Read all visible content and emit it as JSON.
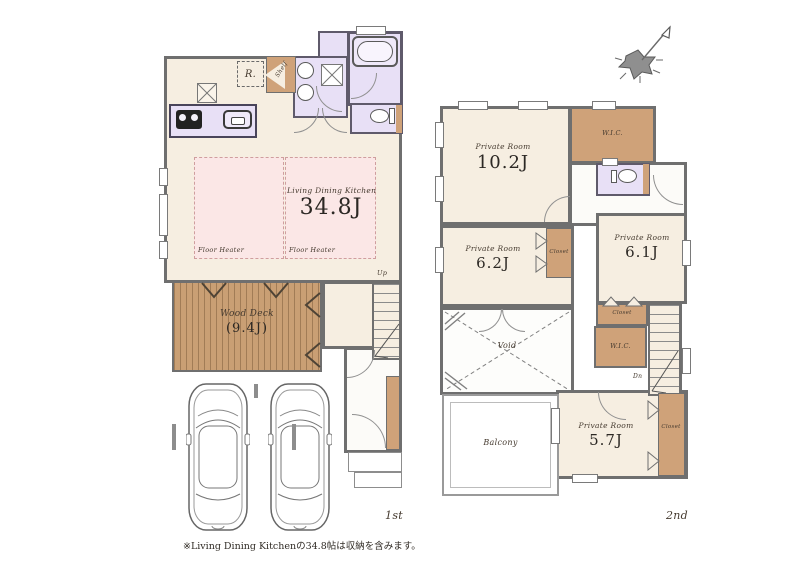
{
  "note": "※Living Dining Kitchenの34.8帖は収納を含みます。",
  "colors": {
    "room_cream": "#f6eee1",
    "floor_heater_pink": "#fbe7e6",
    "wet_area_lavender": "#e8e0f6",
    "wood_brown": "#cfa279",
    "wall_gray": "#6f6f6f"
  },
  "icons": {
    "compass": "north-arrow-icon",
    "cars": "car-top-view-icon",
    "bath": "bathtub-icon",
    "toilet": "toilet-icon"
  },
  "floor1": {
    "label": "1st",
    "ldk_name": "Living Dining Kitchen",
    "ldk_size": "34.8J",
    "floor_heater": "Floor Heater",
    "wood_deck_name": "Wood Deck",
    "wood_deck_size": "(9.4J)",
    "fridge": "R.",
    "shelf": "Shelf",
    "up": "Up"
  },
  "floor2": {
    "label": "2nd",
    "private_room": "Private Room",
    "room1_size": "10.2J",
    "room2_size": "6.2J",
    "room3_size": "6.1J",
    "room4_size": "5.7J",
    "wic": "W.I.C.",
    "closet": "Closet",
    "balcony": "Balcony",
    "void": "Void",
    "dn": "Dn"
  }
}
